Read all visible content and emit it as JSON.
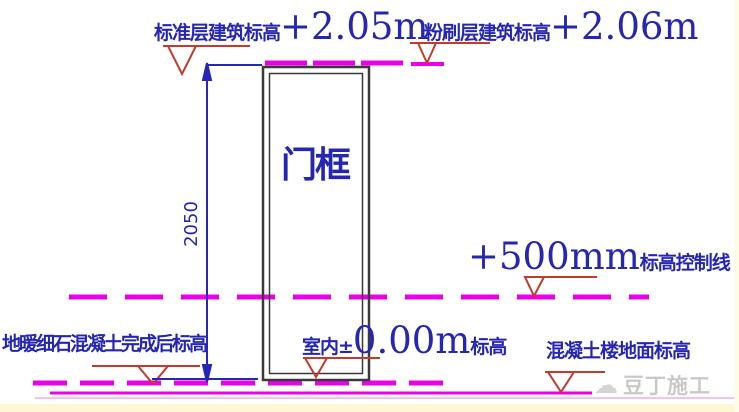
{
  "canvas": {
    "width": 739,
    "height": 412,
    "background": "#ffffff"
  },
  "colors": {
    "text_blue": "#2626b4",
    "line_magenta": "#ea00ea",
    "faint_magenta": "#f2aee4",
    "symbol_red": "#c43a2e",
    "frame_black": "#3a3a3a",
    "watermark_gray": "#c9c9c9",
    "bottom_band_yellow": "#fbf8d2"
  },
  "annotations": {
    "top_left": {
      "label": "标准层建筑标高",
      "value": "+2.05m"
    },
    "top_right": {
      "label": "粉刷层建筑标高",
      "value": "+2.06m"
    },
    "mid_right": {
      "value": "+500mm",
      "label": "标高控制线"
    },
    "bottom_left": {
      "label": "地暖细石混凝土完成后标高"
    },
    "bottom_center": {
      "prefix": "室内±",
      "value": "0.00m",
      "suffix": "标高"
    },
    "bottom_right": {
      "label": "混凝土楼地面标高"
    }
  },
  "door_frame": {
    "label": "门框"
  },
  "dimension": {
    "value": "2050",
    "unit": "mm"
  },
  "watermark": {
    "text": "豆丁施工",
    "icon": "cloud-icon"
  },
  "legend_semantics": {
    "dashed_magenta_lines": "elevation control lines",
    "red_triangles": "elevation level symbols",
    "blue_dimension": "door frame height dimension"
  }
}
